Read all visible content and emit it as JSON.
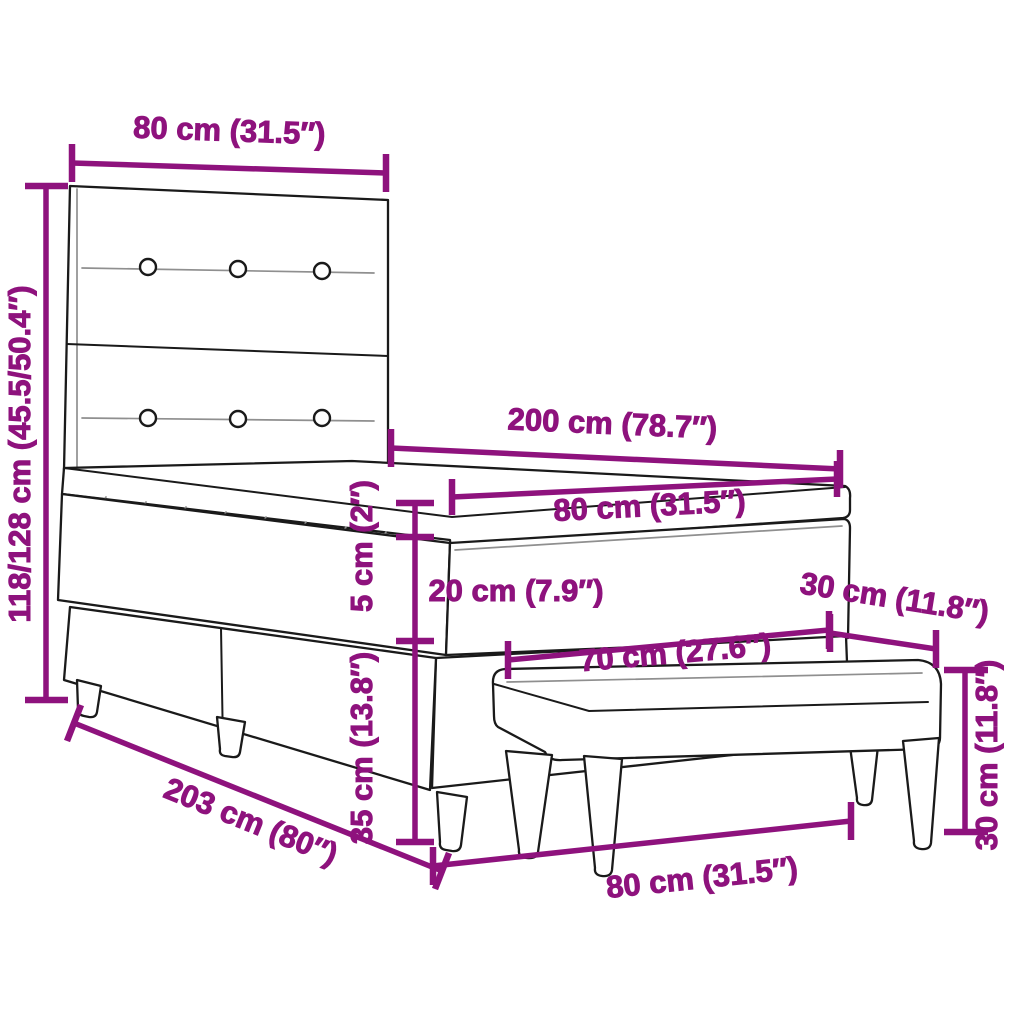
{
  "diagram_title": "Box spring bed with headboard and bench - dimension diagram",
  "colors": {
    "dimension": "#8e127d",
    "outline": "#1a1a1a",
    "detail_line": "#8f8f8f",
    "background": "#ffffff"
  },
  "dims": {
    "headboard_width": {
      "label": "80 cm (31.5″)",
      "cm": 80,
      "inch": 31.5
    },
    "total_height": {
      "label": "118/128 cm (45.5/50.4″)",
      "cm": "118/128",
      "inch": "45.5/50.4"
    },
    "bed_length": {
      "label": "200 cm (78.7″)",
      "cm": 200,
      "inch": 78.7
    },
    "mattress_width": {
      "label": "80 cm (31.5″)",
      "cm": 80,
      "inch": 31.5
    },
    "topper_height": {
      "label": "5 cm (2″)",
      "cm": 5,
      "inch": 2
    },
    "mattress_height": {
      "label": "20 cm (7.9″)",
      "cm": 20,
      "inch": 7.9
    },
    "bench_depth": {
      "label": "30 cm (11.8″)",
      "cm": 30,
      "inch": 11.8
    },
    "bench_length": {
      "label": "70 cm (27.6″)",
      "cm": 70,
      "inch": 27.6
    },
    "base_height": {
      "label": "35 cm (13.8″)",
      "cm": 35,
      "inch": 13.8
    },
    "base_length": {
      "label": "203 cm (80″)",
      "cm": 203,
      "inch": 80
    },
    "bench_span": {
      "label": "80 cm (31.5″)",
      "cm": 80,
      "inch": 31.5
    },
    "bench_height": {
      "label": "30 cm (11.8″)",
      "cm": 30,
      "inch": 11.8
    }
  }
}
